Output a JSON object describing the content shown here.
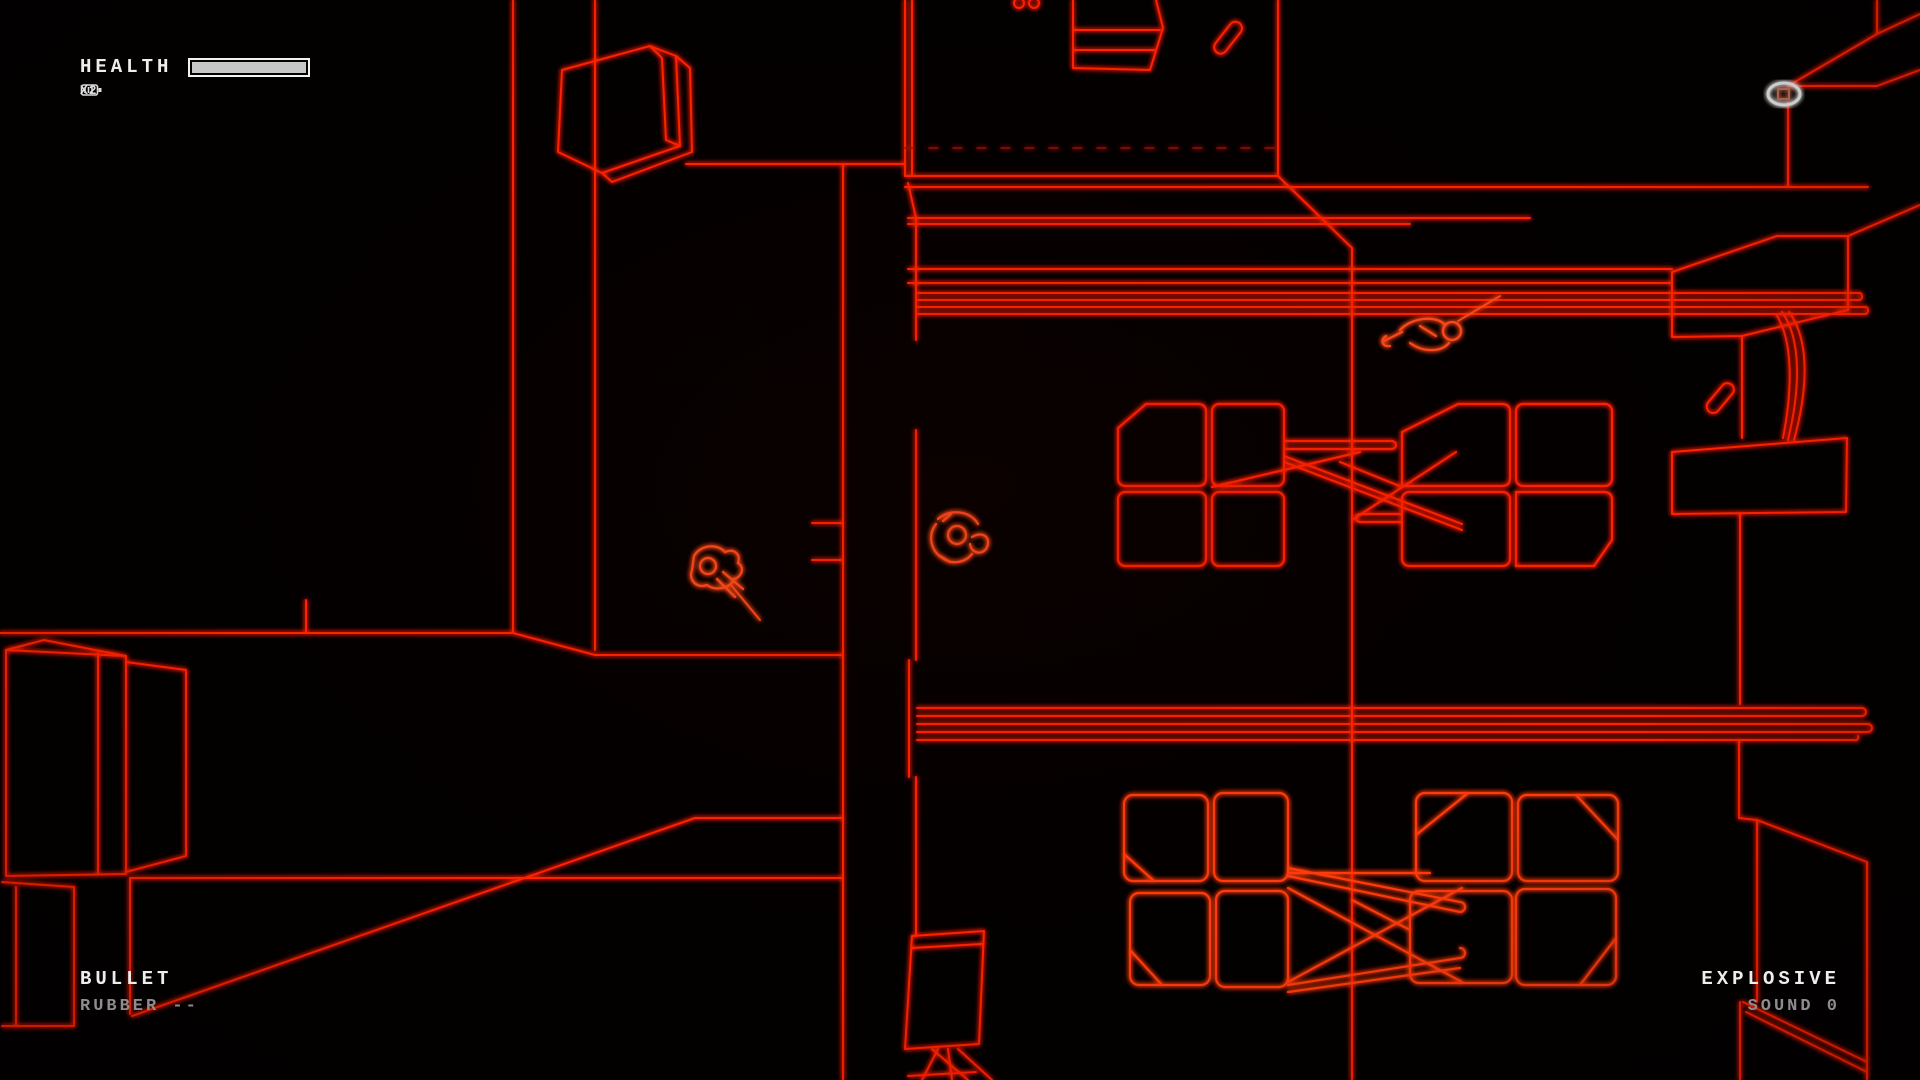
{
  "hud": {
    "health": {
      "label": "HEALTH",
      "fill_pct": 100,
      "reserve_count": "X2",
      "icon": "magazine-icon"
    },
    "bullet_panel": {
      "title": "BULLET",
      "loadout": "RUBBER --"
    },
    "explosive_panel": {
      "title": "EXPLOSIVE",
      "loadout": "SOUND 0"
    }
  },
  "colors": {
    "background": "#030000",
    "wire_red": "#ff2103",
    "wire_bright": "#ff5a22",
    "hud_white": "#ededed",
    "hud_gray": "#8d8d8d",
    "pickup_white": "#e8e8e8"
  },
  "scene": {
    "entities": [
      {
        "name": "player-character",
        "desc": "wireframe figure aiming weapon, lower-left corridor"
      },
      {
        "name": "second-character",
        "desc": "wireframe figure beside dorm wall"
      },
      {
        "name": "downed-enemy",
        "desc": "body lying below upper window slats"
      },
      {
        "name": "highlighted-pickup",
        "desc": "white-outlined item, top right"
      },
      {
        "name": "weapon-pickup-top-room",
        "desc": "red pill-shaped item in top room"
      },
      {
        "name": "weapon-pickup-right",
        "desc": "red pill-shaped item near right desk"
      },
      {
        "name": "bunk-beds-upper",
        "desc": "two 4-panel bed units with cross braces"
      },
      {
        "name": "bunk-beds-lower",
        "desc": "two 4-panel bed units with cross braces"
      },
      {
        "name": "window-slats-upper",
        "desc": "four-line horizontal band"
      },
      {
        "name": "window-slats-lower",
        "desc": "five-line horizontal band"
      },
      {
        "name": "crate",
        "desc": "wireframe cube, top left"
      },
      {
        "name": "lockers",
        "desc": "tall cabinets, bottom left"
      },
      {
        "name": "cabinet-top-room",
        "desc": "slatted cabinet at top wall"
      },
      {
        "name": "desk-right",
        "desc": "angled desks on right wall"
      }
    ]
  }
}
